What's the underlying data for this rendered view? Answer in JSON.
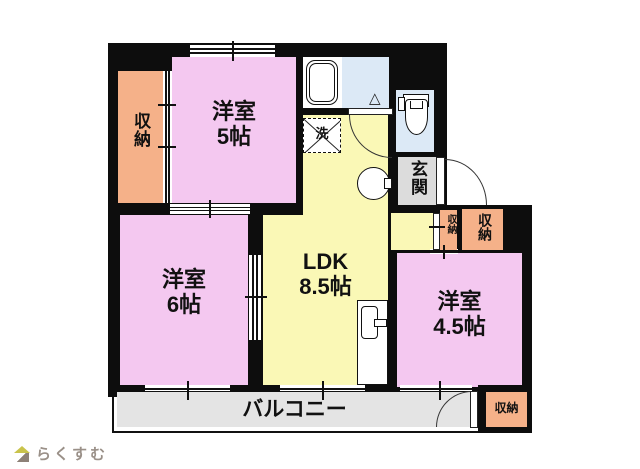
{
  "floorplan": {
    "rooms": {
      "western5": {
        "name": "洋室",
        "size": "5帖"
      },
      "western6": {
        "name": "洋室",
        "size": "6帖"
      },
      "western45": {
        "name": "洋室",
        "size": "4.5帖"
      },
      "ldk": {
        "name": "LDK",
        "size": "8.5帖"
      },
      "entrance": {
        "name": "玄関"
      },
      "balcony": {
        "name": "バルコニー"
      }
    },
    "storages": {
      "left": "収納",
      "hall": "収納",
      "bedroom": "収納",
      "balcony": "収納"
    },
    "fixtures": {
      "laundry_pan": "洗",
      "bath_fold_door": "△"
    },
    "colors": {
      "room_pink": "#f4c8f0",
      "ldk_yellow": "#faf8b6",
      "storage_salmon": "#f5b189",
      "wet_area_blue": "#dce9f6",
      "entrance_gray": "#dcdcdc",
      "balcony_gray": "#e4e4e4",
      "wall_black": "#0d0d0d",
      "logo_roof": "#c9c34b",
      "logo_text": "#9a9088"
    }
  },
  "footer": {
    "logo_text": "らくすむ"
  }
}
